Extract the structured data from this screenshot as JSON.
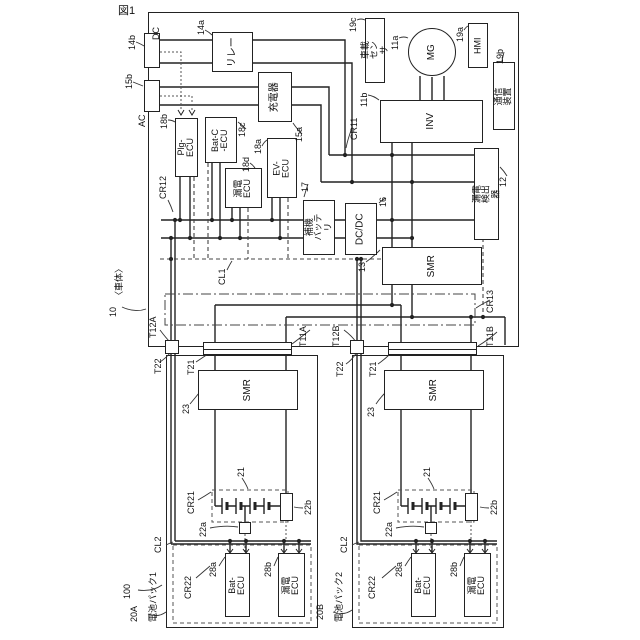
{
  "figure_caption": "図1",
  "vehicle": {
    "ref": "10",
    "name": "〈車体〉",
    "system_ref": "100",
    "inlets": {
      "dc": {
        "ref": "14b",
        "label": "DC"
      },
      "ac": {
        "ref": "15b",
        "label": "AC"
      }
    },
    "components": {
      "relay": {
        "ref": "14a",
        "label": "リレー"
      },
      "charger": {
        "ref": "15a",
        "label": "充電器"
      },
      "plg_ecu": {
        "ref": "18b",
        "label": "Plg-ECU"
      },
      "batc_ecu": {
        "ref": "18c",
        "label": "Bat-C\n-ECU"
      },
      "leak_ecu": {
        "ref": "18d",
        "label": "漏電\nECU"
      },
      "ev_ecu": {
        "ref": "18a",
        "label": "EV-ECU"
      },
      "aux_battery": {
        "ref": "17",
        "label": "補機\nバッテリ"
      },
      "dcdc": {
        "ref": "16",
        "label": "DC/DC"
      },
      "smr": {
        "ref": "13",
        "label": "SMR"
      },
      "leak_detector": {
        "ref": "12",
        "label": "漏電検出器"
      },
      "inverter": {
        "ref": "11b",
        "label": "INV"
      },
      "motor": {
        "ref": "11a",
        "label": "MG"
      },
      "onboard_sensor": {
        "ref": "19c",
        "label": "車載センサ"
      },
      "hmi": {
        "ref": "19a",
        "label": "HMI"
      },
      "comm_device": {
        "ref": "19b",
        "label": "通信装置"
      }
    },
    "wiring": {
      "cr11": "CR11",
      "cr12": "CR12",
      "cr13": "CR13",
      "cl1": "CL1"
    },
    "terminals": {
      "t12a": "T12A",
      "t11a": "T11A",
      "t12b": "T12B",
      "t11b": "T11B"
    }
  },
  "packs": [
    {
      "name": "電池パック1",
      "ref": "20A",
      "terminals": {
        "t22": "T22",
        "t21": "T21"
      },
      "smr": {
        "ref": "23",
        "label": "SMR"
      },
      "battery_ref": "21",
      "service_plug_ref": "22a",
      "sensor_ref": "22b",
      "wiring": {
        "cr21": "CR21",
        "cr22": "CR22",
        "cl2": "CL2"
      },
      "ecus": [
        {
          "ref": "28a",
          "label": "Bat-ECU"
        },
        {
          "ref": "28b",
          "label": "漏電ECU"
        }
      ]
    },
    {
      "name": "電池パック2",
      "ref": "20B",
      "terminals": {
        "t22": "T22",
        "t21": "T21"
      },
      "smr": {
        "ref": "23",
        "label": "SMR"
      },
      "battery_ref": "21",
      "service_plug_ref": "22a",
      "sensor_ref": "22b",
      "wiring": {
        "cr21": "CR21",
        "cr22": "CR22",
        "cl2": "CL2"
      },
      "ecus": [
        {
          "ref": "28a",
          "label": "Bat-ECU"
        },
        {
          "ref": "28b",
          "label": "漏電ECU"
        }
      ]
    }
  ]
}
